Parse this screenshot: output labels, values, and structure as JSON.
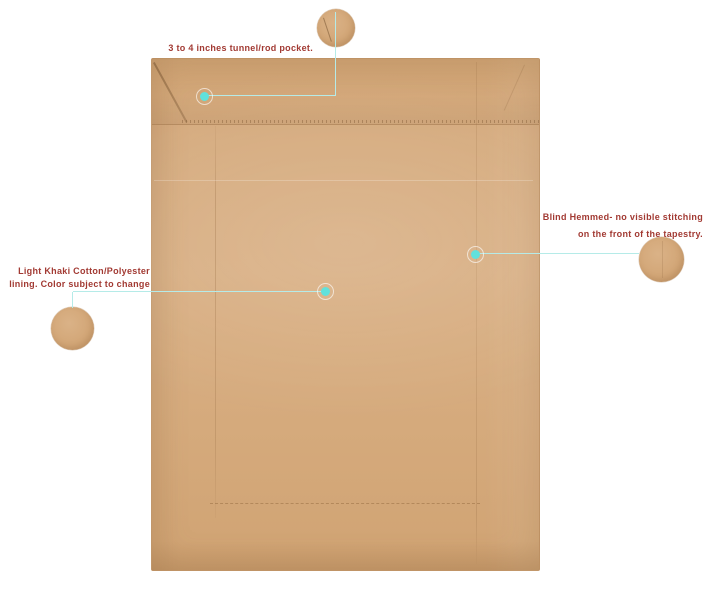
{
  "annotations": {
    "rod_pocket": {
      "text": "3 to 4 inches tunnel/rod pocket."
    },
    "blind_hem": {
      "line1": "Blind Hemmed- no visible stitching",
      "line2": "on the front of the tapestry."
    },
    "lining": {
      "line1": "Light Khaki Cotton/Polyester",
      "line2": "lining. Color subject to change"
    }
  },
  "colors": {
    "fabric": "#D5AA7D",
    "accent_dot": "#61E1DC",
    "connector_line": "#B5EBE8",
    "annotation_text": "#A23A33",
    "background": "#FFFFFF"
  }
}
